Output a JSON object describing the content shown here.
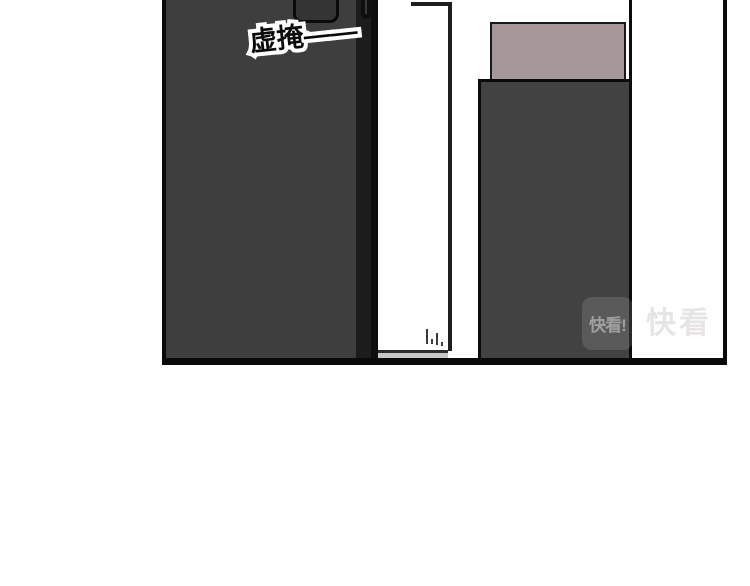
{
  "panel": {
    "sfx_text": "虚掩——",
    "colors": {
      "panel_border": "#0a0a0a",
      "door": "#3e3e3e",
      "door_edge": "#0d0d0d",
      "door_window": "#343434",
      "cabinet": "#424242",
      "cabinet_top_box": "#a59798",
      "baseboard": "#c7c7c7",
      "background": "#ffffff"
    }
  },
  "watermark": {
    "logo_text": "快看!",
    "brand_text": "快看"
  }
}
